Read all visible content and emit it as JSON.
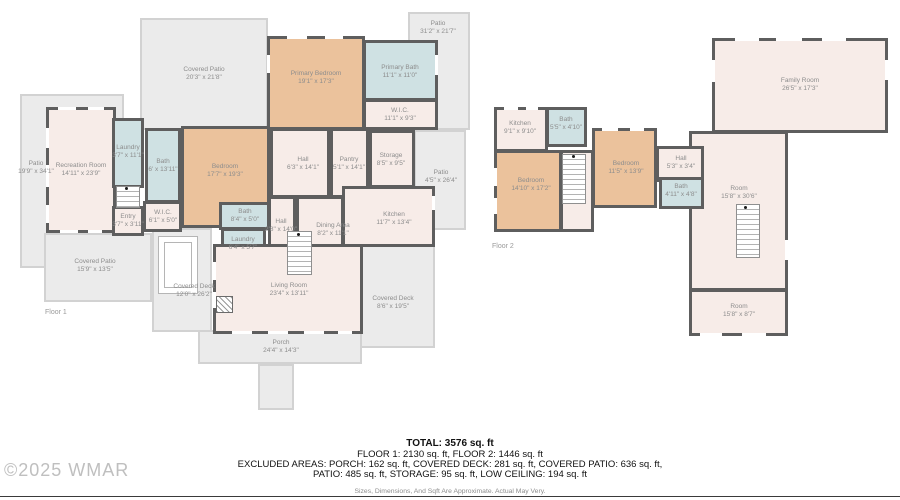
{
  "watermark": "©2025 WMAR",
  "summary": {
    "total": "TOTAL: 3576 sq. ft",
    "line2": "FLOOR 1: 2130 sq. ft, FLOOR 2: 1446 sq. ft",
    "line3": "EXCLUDED AREAS: PORCH: 162 sq. ft, COVERED DECK: 281 sq. ft, COVERED PATIO: 636 sq. ft,",
    "line4": "PATIO: 485 sq. ft, STORAGE: 95 sq. ft, LOW CEILING: 194 sq. ft",
    "disclaimer": "Sizes, Dimensions, And Sqft Are Approximate. Actual May Very."
  },
  "floors": [
    {
      "label": "Floor 1"
    },
    {
      "label": "Floor 2"
    }
  ],
  "colors": {
    "wall": "#5e5e5e",
    "room": "#f7ece8",
    "accent": "#ebc29c",
    "wet": "#cfe1e3",
    "patio": "#ebebeb"
  },
  "rooms": [
    {
      "id": "patio-left",
      "floor": 1,
      "name": "Patio",
      "dims": "19'9\" x 34'1\"",
      "type": "patio"
    },
    {
      "id": "covered-patio-top",
      "floor": 1,
      "name": "Covered Patio",
      "dims": "20'3\" x 21'8\"",
      "type": "patio"
    },
    {
      "id": "patio-top-right",
      "floor": 1,
      "name": "Patio",
      "dims": "31'2\" x 21'7\"",
      "type": "patio"
    },
    {
      "id": "patio-right-strip",
      "floor": 1,
      "name": "Patio",
      "dims": "4'5\" x 26'4\"",
      "type": "patio"
    },
    {
      "id": "covered-patio-bl",
      "floor": 1,
      "name": "Covered Patio",
      "dims": "15'9\" x 13'5\"",
      "type": "patio"
    },
    {
      "id": "covered-deck-left",
      "floor": 1,
      "name": "Covered Deck",
      "dims": "12'0\" x 26'2\"",
      "type": "patio"
    },
    {
      "id": "covered-deck-right",
      "floor": 1,
      "name": "Covered Deck",
      "dims": "8'6\" x 19'5\"",
      "type": "patio"
    },
    {
      "id": "porch",
      "floor": 1,
      "name": "Porch",
      "dims": "24'4\" x 14'3\"",
      "type": "patio"
    },
    {
      "id": "porch-stem",
      "floor": 1,
      "name": "",
      "dims": "",
      "type": "patio"
    },
    {
      "id": "deck-inset-outer",
      "floor": 1,
      "name": "",
      "dims": "",
      "type": "deco-white"
    },
    {
      "id": "deck-inset-inner",
      "floor": 1,
      "name": "",
      "dims": "",
      "type": "deco-white"
    },
    {
      "id": "rec-room",
      "floor": 1,
      "name": "Recreation Room",
      "dims": "14'11\" x 23'9\"",
      "type": "room"
    },
    {
      "id": "laundry-1",
      "floor": 1,
      "name": "Laundry",
      "dims": "3'7\" x 11'1\"",
      "type": "wet"
    },
    {
      "id": "entry",
      "floor": 1,
      "name": "Entry",
      "dims": "3'7\" x 3'11\"",
      "type": "room"
    },
    {
      "id": "wic-1",
      "floor": 1,
      "name": "W.I.C.",
      "dims": "6'1\" x 5'0\"",
      "type": "room"
    },
    {
      "id": "bath-1",
      "floor": 1,
      "name": "Bath",
      "dims": "6' x 13'11\"",
      "type": "wet"
    },
    {
      "id": "bedroom-1",
      "floor": 1,
      "name": "Bedroom",
      "dims": "17'7\" x 19'3\"",
      "type": "accent"
    },
    {
      "id": "primary-bedroom",
      "floor": 1,
      "name": "Primary Bedroom",
      "dims": "19'1\" x 17'3\"",
      "type": "accent"
    },
    {
      "id": "primary-bath",
      "floor": 1,
      "name": "Primary Bath",
      "dims": "11'1\" x 11'0\"",
      "type": "wet"
    },
    {
      "id": "wic-primary",
      "floor": 1,
      "name": "W.I.C.",
      "dims": "11'1\" x 9'3\"",
      "type": "room"
    },
    {
      "id": "hall-1",
      "floor": 1,
      "name": "Hall",
      "dims": "6'3\" x 14'1\"",
      "type": "room"
    },
    {
      "id": "pantry",
      "floor": 1,
      "name": "Pantry",
      "dims": "5'1\" x 14'1\"",
      "type": "room"
    },
    {
      "id": "storage",
      "floor": 1,
      "name": "Storage",
      "dims": "8'5\" x 9'5\"",
      "type": "room"
    },
    {
      "id": "kitchen",
      "floor": 1,
      "name": "Kitchen",
      "dims": "11'7\" x 13'4\"",
      "type": "room"
    },
    {
      "id": "dining-area",
      "floor": 1,
      "name": "Dining Area",
      "dims": "8'2\" x 11'1\"",
      "type": "room"
    },
    {
      "id": "hall-2",
      "floor": 1,
      "name": "Hall",
      "dims": "2'8\" x 14'0\"",
      "type": "room"
    },
    {
      "id": "bath-2",
      "floor": 1,
      "name": "Bath",
      "dims": "8'4\" x 5'0\"",
      "type": "wet"
    },
    {
      "id": "laundry-2",
      "floor": 1,
      "name": "Laundry",
      "dims": "6'4\" x 5'7\"",
      "type": "wet"
    },
    {
      "id": "living-room",
      "floor": 1,
      "name": "Living Room",
      "dims": "23'4\" x 13'11\"",
      "type": "room"
    },
    {
      "id": "f2-family-room",
      "floor": 2,
      "name": "Family Room",
      "dims": "26'5\" x 17'3\"",
      "type": "room"
    },
    {
      "id": "f2-room-big",
      "floor": 2,
      "name": "Room",
      "dims": "15'8\" x 30'6\"",
      "type": "room"
    },
    {
      "id": "f2-room-small",
      "floor": 2,
      "name": "Room",
      "dims": "15'8\" x 8'7\"",
      "type": "room"
    },
    {
      "id": "f2-kitchen",
      "floor": 2,
      "name": "Kitchen",
      "dims": "9'1\" x 9'10\"",
      "type": "room"
    },
    {
      "id": "f2-bath-1",
      "floor": 2,
      "name": "Bath",
      "dims": "5'5\" x 4'10\"",
      "type": "wet"
    },
    {
      "id": "f2-bedroom-1",
      "floor": 2,
      "name": "Bedroom",
      "dims": "14'10\" x 17'2\"",
      "type": "accent"
    },
    {
      "id": "f2-stair-shaft",
      "floor": 2,
      "name": "",
      "dims": "",
      "type": "room"
    },
    {
      "id": "f2-bedroom-2",
      "floor": 2,
      "name": "Bedroom",
      "dims": "11'5\" x 13'9\"",
      "type": "accent"
    },
    {
      "id": "f2-hall",
      "floor": 2,
      "name": "Hall",
      "dims": "5'3\" x 3'4\"",
      "type": "room"
    },
    {
      "id": "f2-bath-2",
      "floor": 2,
      "name": "Bath",
      "dims": "4'11\" x 4'8\"",
      "type": "wet"
    },
    {
      "id": "stairs-1",
      "floor": 1,
      "name": "",
      "dims": "",
      "type": "stairs"
    },
    {
      "id": "stairs-2",
      "floor": 1,
      "name": "",
      "dims": "",
      "type": "stairs"
    },
    {
      "id": "stairs-3",
      "floor": 2,
      "name": "",
      "dims": "",
      "type": "stairs"
    },
    {
      "id": "stairs-4",
      "floor": 2,
      "name": "",
      "dims": "",
      "type": "stairs"
    }
  ]
}
